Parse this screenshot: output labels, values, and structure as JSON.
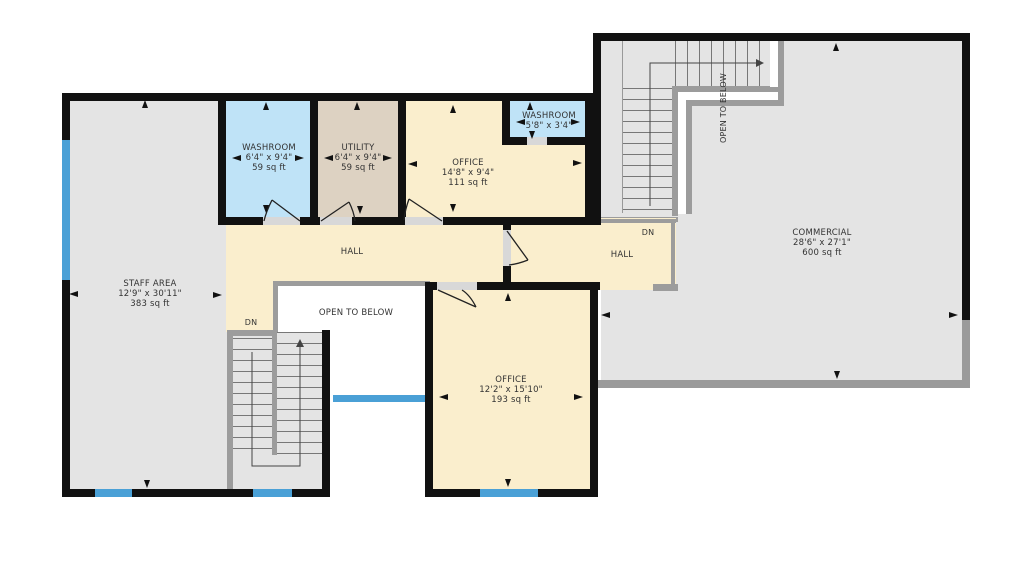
{
  "rooms": {
    "staff_area": {
      "name": "STAFF AREA",
      "dims": "12'9\" x 30'11\"",
      "area": "383 sq ft"
    },
    "washroom_top": {
      "name": "WASHROOM",
      "dims": "6'4\" x 9'4\"",
      "area": "59 sq ft"
    },
    "utility": {
      "name": "UTILITY",
      "dims": "6'4\" x 9'4\"",
      "area": "59 sq ft"
    },
    "office_upper": {
      "name": "OFFICE",
      "dims": "14'8\" x 9'4\"",
      "area": "111 sq ft"
    },
    "washroom_small": {
      "name": "WASHROOM",
      "dims": "5'8\" x 3'4\""
    },
    "hall_left": {
      "name": "HALL"
    },
    "hall_right": {
      "name": "HALL"
    },
    "office_lower": {
      "name": "OFFICE",
      "dims": "12'2\" x 15'10\"",
      "area": "193 sq ft"
    },
    "commercial": {
      "name": "COMMERCIAL",
      "dims": "28'6\" x 27'1\"",
      "area": "600 sq ft"
    }
  },
  "annotations": {
    "open_to_below_left": "OPEN TO BELOW",
    "open_to_below_right": "OPEN TO BELOW",
    "dn_left": "DN",
    "dn_right": "DN"
  },
  "colors": {
    "floor_gray": "#e4e4e4",
    "floor_cream": "#faeecd",
    "floor_blue": "#bfe3f7",
    "floor_tan": "#ddd2c2",
    "wall_black": "#111111",
    "window_blue": "#4aa0d6",
    "railing_gray": "#9c9c9c"
  }
}
